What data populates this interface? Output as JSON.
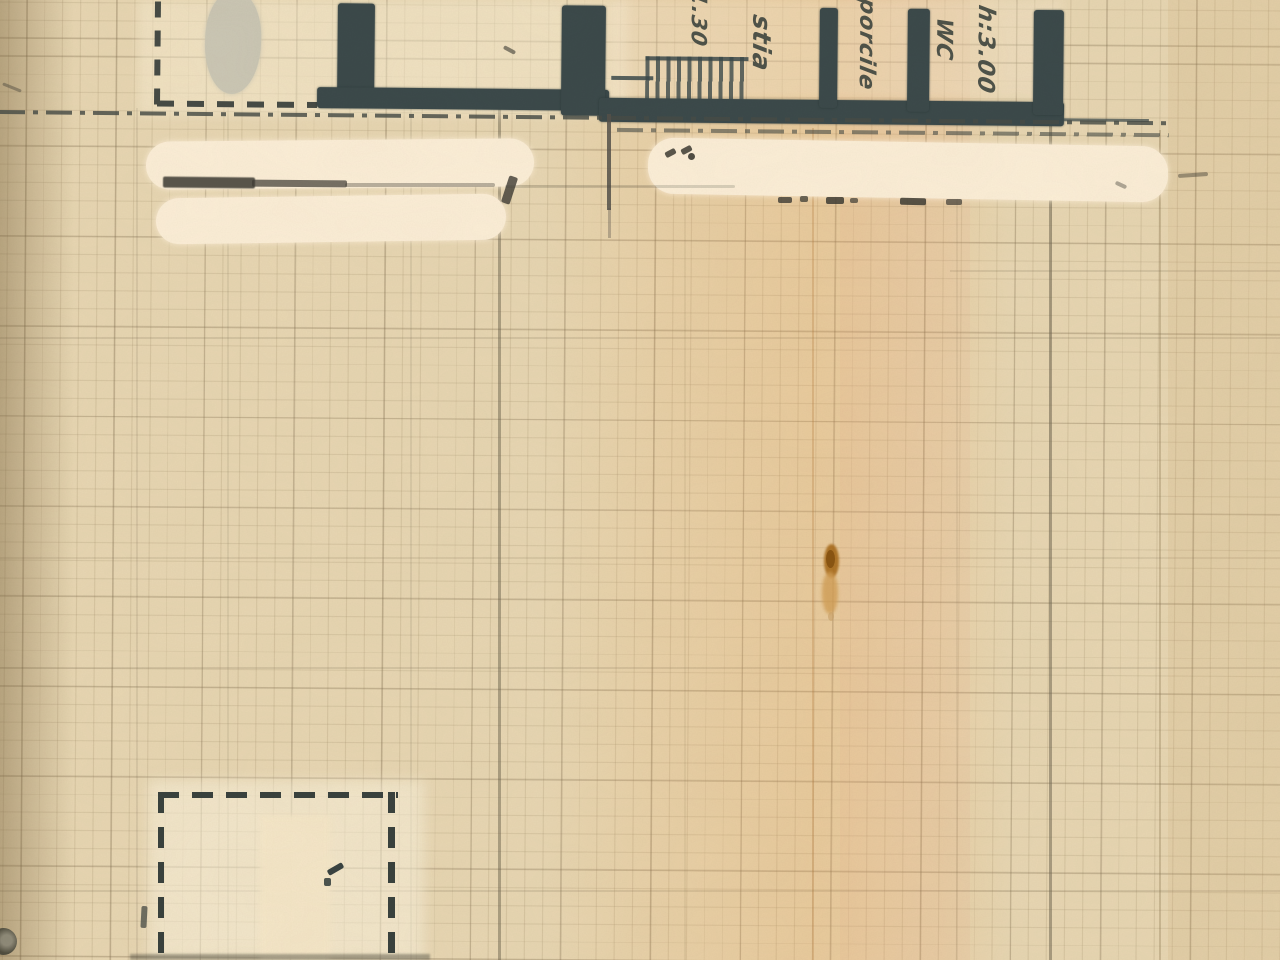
{
  "labels": {
    "stairs_dimension": "1.30",
    "room_small": "stia",
    "room_porcile": "porcile",
    "room_wc": "WC",
    "ceiling_height": "h:3.00"
  },
  "colors": {
    "paper": "#e8d7b3",
    "paper_light": "#f4e7c9",
    "whiteout": "#fcefd8",
    "grayout": "#cbc7b5",
    "wall_ink": "#3c4a4b",
    "dash_ink": "#474c46",
    "pencil": "#8a8172",
    "hand_ink": "#3a423c",
    "stain_dark": "#a96d1d",
    "stain_light": "#d3a057"
  }
}
